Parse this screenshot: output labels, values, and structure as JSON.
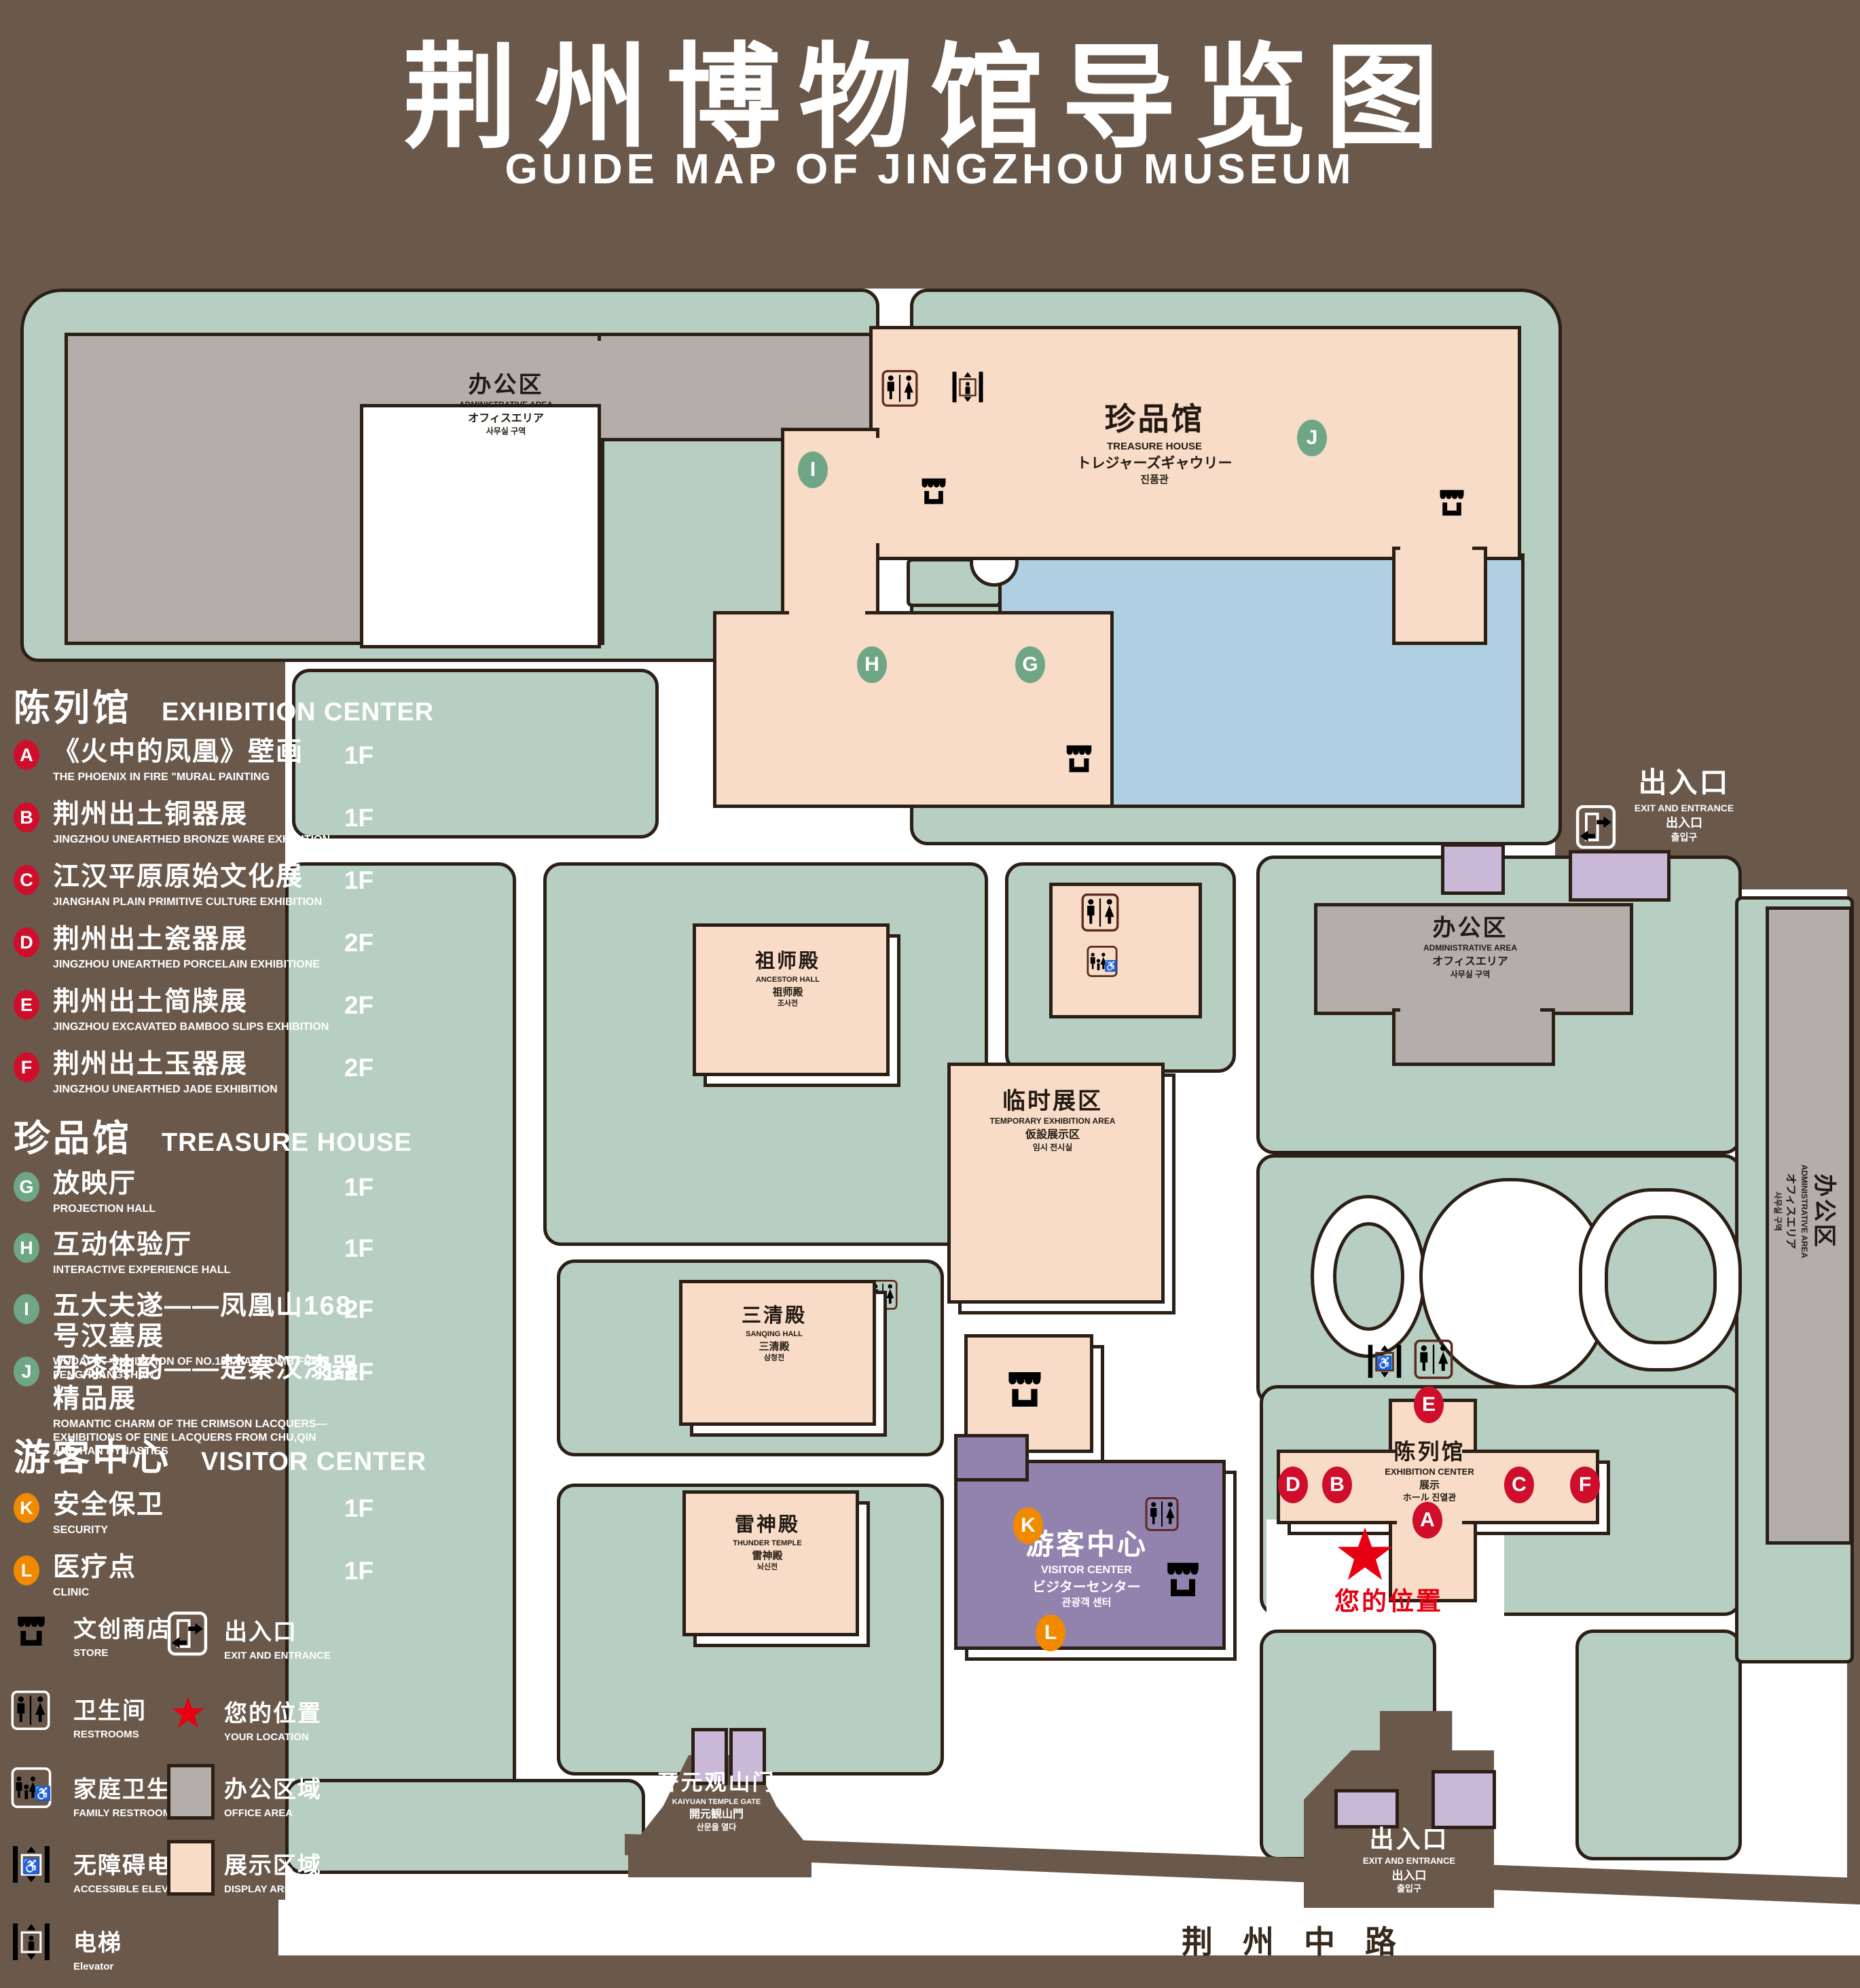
{
  "title": {
    "zh": "荆州博物馆导览图",
    "en": "GUIDE MAP OF JINGZHOU MUSEUM"
  },
  "legend": {
    "sections": [
      {
        "zh": "陈列馆",
        "en": "EXHIBITION CENTER",
        "items": [
          {
            "key": "A",
            "zh": "《火中的凤凰》壁画",
            "en": "THE PHOENIX IN FIRE \"MURAL PAINTING",
            "floor": "1F"
          },
          {
            "key": "B",
            "zh": "荆州出土铜器展",
            "en": "JINGZHOU UNEARTHED BRONZE WARE EXHIBITION",
            "floor": "1F"
          },
          {
            "key": "C",
            "zh": "江汉平原原始文化展",
            "en": "JIANGHAN PLAIN PRIMITIVE CULTURE EXHIBITION",
            "floor": "1F"
          },
          {
            "key": "D",
            "zh": "荆州出土瓷器展",
            "en": "JINGZHOU UNEARTHED PORCELAIN EXHIBITIONE",
            "floor": "2F"
          },
          {
            "key": "E",
            "zh": "荆州出土简牍展",
            "en": "JINGZHOU EXCAVATED BAMBOO SLIPS EXHIBITION",
            "floor": "2F"
          },
          {
            "key": "F",
            "zh": "荆州出土玉器展",
            "en": "JINGZHOU UNEARTHED JADE EXHIBITION",
            "floor": "2F"
          }
        ]
      },
      {
        "zh": "珍品馆",
        "en": "TREASURE HOUSE",
        "items": [
          {
            "key": "G",
            "zh": "放映厅",
            "en": "PROJECTION HALL",
            "floor": "1F"
          },
          {
            "key": "H",
            "zh": "互动体验厅",
            "en": "INTERACTIVE EXPERIENCE HALL",
            "floor": "1F"
          },
          {
            "key": "I",
            "zh": "五大夫遂——凤凰山168号汉墓展",
            "en": "WUDAFU—EXHIBITION OF NO.168 HAN TOMB FROM FENGHUANGSHAN",
            "floor": "2F"
          },
          {
            "key": "J",
            "zh": "丹漆神韵——楚秦汉漆器精品展",
            "en": "ROMANTIC CHARM OF THE CRIMSON LACQUERS—EXHIBITIONS OF FINE LACQUERS FROM CHU,QIN AND HAN DYNASTIES",
            "floor": "1-2F"
          }
        ]
      },
      {
        "zh": "游客中心",
        "en": "VISITOR CENTER",
        "items": [
          {
            "key": "K",
            "zh": "安全保卫",
            "en": "SECURITY",
            "floor": "1F"
          },
          {
            "key": "L",
            "zh": "医疗点",
            "en": "CLINIC",
            "floor": "1F"
          }
        ]
      }
    ],
    "symbols": [
      {
        "icon": "store-icon",
        "zh": "文创商店",
        "en": "STORE"
      },
      {
        "icon": "restroom-icon",
        "zh": "卫生间",
        "en": "RESTROOMS"
      },
      {
        "icon": "family-restroom-icon",
        "zh": "家庭卫生间",
        "en": "FAMILY RESTROOMS"
      },
      {
        "icon": "accessible-elevator-icon",
        "zh": "无障碍电梯",
        "en": "ACCESSIBLE ELEVATOR"
      },
      {
        "icon": "elevator-icon",
        "zh": "电梯",
        "en": "Elevator"
      },
      {
        "icon": "exit-icon",
        "zh": "出入口",
        "en": "EXIT AND ENTRANCE"
      },
      {
        "icon": "your-location-icon",
        "zh": "您的位置",
        "en": "YOUR LOCATION"
      },
      {
        "icon": "office-area-swatch",
        "zh": "办公区域",
        "en": "OFFICE AREA"
      },
      {
        "icon": "display-area-swatch",
        "zh": "展示区域",
        "en": "DISPLAY AREA"
      }
    ]
  },
  "map": {
    "buildings": {
      "admin": {
        "zh": "办公区",
        "en": "ADMINISTRATIVE AREA",
        "jp": "オフィスエリア",
        "kr": "사무실 구역"
      },
      "treasure": {
        "zh": "珍品馆",
        "en": "TREASURE HOUSE",
        "jp": "トレジャーズギャウリー",
        "kr": "진품관"
      },
      "ancestor": {
        "zh": "祖师殿",
        "en": "ANCESTOR HALL",
        "jp": "祖师殿",
        "kr": "조사전"
      },
      "temporary": {
        "zh": "临时展区",
        "en": "TEMPORARY EXHIBITION AREA",
        "jp": "仮設展示区",
        "kr": "임시 전시실"
      },
      "sanqing": {
        "zh": "三清殿",
        "en": "SANQING HALL",
        "jp": "三清殿",
        "kr": "삼청전"
      },
      "thunder": {
        "zh": "雷神殿",
        "en": "THUNDER TEMPLE",
        "jp": "雷神殿",
        "kr": "뇌신전"
      },
      "visitor": {
        "zh": "游客中心",
        "en": "VISITOR CENTER",
        "jp": "ビジターセンター",
        "kr": "관광객 센터"
      },
      "exhibition": {
        "zh": "陈列馆",
        "en": "EXHIBITION CENTER",
        "jp": "展示",
        "kr": "ホール 진열관"
      },
      "gate": {
        "zh": "开元观山门",
        "en": "KAIYUAN TEMPLE GATE",
        "jp": "開元観山門",
        "kr": "산문을 열다"
      },
      "exit": {
        "zh": "出入口",
        "en": "EXIT AND ENTRANCE",
        "jp": "出入口",
        "kr": "출입구"
      }
    },
    "road": "荆州中路",
    "your_location": "您的位置",
    "markers": [
      {
        "letter": "A",
        "group": "exhibition-center"
      },
      {
        "letter": "B",
        "group": "exhibition-center"
      },
      {
        "letter": "C",
        "group": "exhibition-center"
      },
      {
        "letter": "D",
        "group": "exhibition-center"
      },
      {
        "letter": "E",
        "group": "exhibition-center"
      },
      {
        "letter": "F",
        "group": "exhibition-center"
      },
      {
        "letter": "G",
        "group": "treasure-house"
      },
      {
        "letter": "H",
        "group": "treasure-house"
      },
      {
        "letter": "I",
        "group": "treasure-house"
      },
      {
        "letter": "J",
        "group": "treasure-house"
      },
      {
        "letter": "K",
        "group": "visitor-center"
      },
      {
        "letter": "L",
        "group": "visitor-center"
      }
    ]
  },
  "colors": {
    "background": "#6a594b",
    "display_area": "#f8dcc8",
    "office_area": "#b4aeaa",
    "green_space": "#b7cfc2",
    "water": "#afd0e2",
    "visitor_center": "#9183ae",
    "gate_building": "#cab8d8",
    "marker_red": "#cf0e2c",
    "marker_green": "#6fa786",
    "marker_orange": "#f28a00",
    "location_red": "#e60012"
  }
}
